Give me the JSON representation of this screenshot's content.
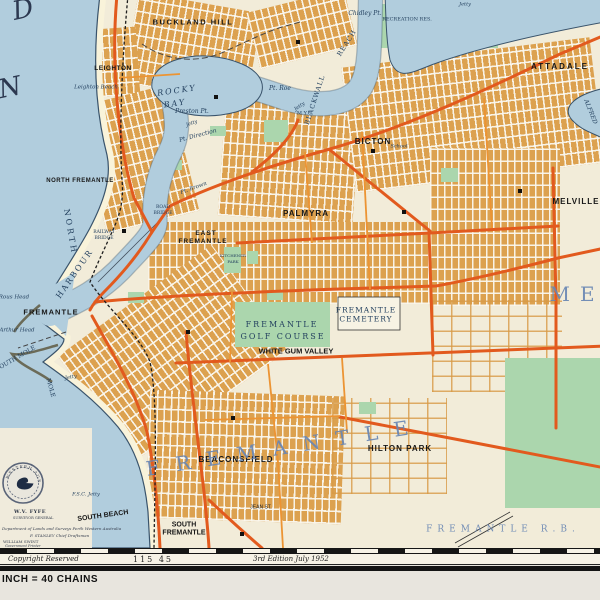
{
  "map": {
    "labels": [
      {
        "t": "D",
        "cls": "lbig",
        "x": 23,
        "y": 10,
        "fs": 26,
        "r": -12
      },
      {
        "t": "N",
        "cls": "lbig",
        "x": 10,
        "y": 88,
        "fs": 26,
        "r": -12
      },
      {
        "t": "BUCKLAND HILL",
        "cls": "lb",
        "x": 193,
        "y": 22,
        "fs": 7.5,
        "ls": 1.5
      },
      {
        "t": "LEIGHTON",
        "cls": "lb",
        "x": 113,
        "y": 69,
        "fs": 6.5,
        "ls": 0.5
      },
      {
        "t": "Leighton Beach",
        "cls": "li",
        "x": 96,
        "y": 88,
        "fs": 5.5
      },
      {
        "t": "ROCKY",
        "cls": "li",
        "x": 177,
        "y": 91,
        "fs": 8,
        "ls": 2,
        "r": -8
      },
      {
        "t": "BAY",
        "cls": "li",
        "x": 175,
        "y": 104,
        "fs": 8,
        "ls": 2,
        "r": -8
      },
      {
        "t": "NORTH FREMANTLE",
        "cls": "lb",
        "x": 80,
        "y": 181,
        "fs": 6,
        "ls": 0.5
      },
      {
        "t": "NORTH",
        "cls": "ls",
        "x": 70,
        "y": 232,
        "fs": 8,
        "ls": 3,
        "r": 80
      },
      {
        "t": "HARBOUR",
        "cls": "ls",
        "x": 75,
        "y": 274,
        "fs": 8,
        "ls": 2,
        "r": -55
      },
      {
        "t": "BLACKWALL",
        "cls": "ls",
        "x": 315,
        "y": 100,
        "fs": 6.5,
        "ls": 1,
        "r": -72
      },
      {
        "t": "REACH",
        "cls": "ls",
        "x": 347,
        "y": 43,
        "fs": 6.5,
        "ls": 1,
        "r": -58
      },
      {
        "t": "Chidley Pt.",
        "cls": "li",
        "x": 365,
        "y": 14,
        "fs": 6
      },
      {
        "t": "Jetty",
        "cls": "li",
        "x": 465,
        "y": 5,
        "fs": 5
      },
      {
        "t": "RECREATION RES.",
        "cls": "ls",
        "x": 407,
        "y": 20,
        "fs": 5
      },
      {
        "t": "ATTADALE",
        "cls": "lb",
        "x": 560,
        "y": 67,
        "fs": 8,
        "ls": 2
      },
      {
        "t": "ALFRED",
        "cls": "li",
        "x": 590,
        "y": 112,
        "fs": 6,
        "r": 68
      },
      {
        "t": "Pt. Roe",
        "cls": "li",
        "x": 280,
        "y": 89,
        "fs": 6
      },
      {
        "t": "Preston Pt.",
        "cls": "li",
        "x": 192,
        "y": 112,
        "fs": 6
      },
      {
        "t": "Jetty",
        "cls": "li",
        "x": 192,
        "y": 124,
        "fs": 5,
        "r": -20
      },
      {
        "t": "Pt. Direction",
        "cls": "li",
        "x": 198,
        "y": 136,
        "fs": 6,
        "r": -15
      },
      {
        "t": "Jetty",
        "cls": "li",
        "x": 300,
        "y": 107,
        "fs": 5,
        "r": -35
      },
      {
        "t": "M.Y.C.",
        "cls": "ls",
        "x": 305,
        "y": 114,
        "fs": 5
      },
      {
        "t": "BICTON",
        "cls": "lb",
        "x": 373,
        "y": 142,
        "fs": 8,
        "ls": 1
      },
      {
        "t": "School",
        "cls": "li",
        "x": 399,
        "y": 147,
        "fs": 5
      },
      {
        "t": "Pt. Brown",
        "cls": "li",
        "x": 194,
        "y": 189,
        "fs": 5.5,
        "r": -20
      },
      {
        "t": "ROAD",
        "cls": "ls",
        "x": 163,
        "y": 208,
        "fs": 4.5
      },
      {
        "t": "BRIDGE",
        "cls": "ls",
        "x": 163,
        "y": 214,
        "fs": 4.5
      },
      {
        "t": "RAILWAY",
        "cls": "ls",
        "x": 104,
        "y": 233,
        "fs": 4.5
      },
      {
        "t": "BRIDGE",
        "cls": "ls",
        "x": 104,
        "y": 239,
        "fs": 4.5
      },
      {
        "t": "PALMYRA",
        "cls": "lb",
        "x": 306,
        "y": 214,
        "fs": 8,
        "ls": 1
      },
      {
        "t": "EAST",
        "cls": "lb",
        "x": 206,
        "y": 234,
        "fs": 6.5,
        "ls": 1
      },
      {
        "t": "FREMANTLE",
        "cls": "lb",
        "x": 203,
        "y": 242,
        "fs": 6.5,
        "ls": 1
      },
      {
        "t": "KITCHENER",
        "cls": "ls",
        "x": 233,
        "y": 256,
        "fs": 4
      },
      {
        "t": "PARK",
        "cls": "ls",
        "x": 233,
        "y": 262,
        "fs": 4
      },
      {
        "t": "MELVILLE",
        "cls": "lb",
        "x": 576,
        "y": 202,
        "fs": 8,
        "ls": 1
      },
      {
        "t": "ME",
        "cls": "lblue",
        "x": 577,
        "y": 294,
        "fs": 20,
        "ls": 10
      },
      {
        "t": "FREMANTLE",
        "cls": "lb",
        "x": 51,
        "y": 312,
        "fs": 7.5,
        "ls": 1
      },
      {
        "t": "Rous Head",
        "cls": "li",
        "x": 14,
        "y": 298,
        "fs": 5.5
      },
      {
        "t": "Arthur Head",
        "cls": "li",
        "x": 17,
        "y": 331,
        "fs": 5.5
      },
      {
        "t": "SOUTH MOLE",
        "cls": "ls",
        "x": 16,
        "y": 359,
        "fs": 6,
        "r": -30
      },
      {
        "t": "MOLE",
        "cls": "ls",
        "x": 50,
        "y": 388,
        "fs": 6,
        "r": 75
      },
      {
        "t": "Jetty",
        "cls": "li",
        "x": 71,
        "y": 378,
        "fs": 5,
        "r": -10
      },
      {
        "t": "FREMANTLE",
        "cls": "ls",
        "x": 282,
        "y": 325,
        "fs": 8,
        "ls": 2
      },
      {
        "t": "GOLF COURSE",
        "cls": "ls",
        "x": 283,
        "y": 337,
        "fs": 8,
        "ls": 2
      },
      {
        "t": "WHITE GUM VALLEY",
        "cls": "lb",
        "x": 296,
        "y": 351,
        "fs": 7.5
      },
      {
        "t": "FREMANTLE",
        "cls": "ls",
        "x": 366,
        "y": 310,
        "fs": 7.5,
        "ls": 1
      },
      {
        "t": "CEMETERY",
        "cls": "ls",
        "x": 366,
        "y": 319,
        "fs": 7.5,
        "ls": 1
      },
      {
        "t": "BEACONSFIELD",
        "cls": "lb",
        "x": 236,
        "y": 460,
        "fs": 8,
        "ls": 1
      },
      {
        "t": "HILTON PARK",
        "cls": "lb",
        "x": 400,
        "y": 449,
        "fs": 8,
        "ls": 1
      },
      {
        "t": "FREMANTLE",
        "cls": "lblue",
        "x": 285,
        "y": 447,
        "fs": 20,
        "ls": 16,
        "r": -9
      },
      {
        "t": "F.S.C. Jetty",
        "cls": "li",
        "x": 86,
        "y": 495,
        "fs": 5
      },
      {
        "t": "SOUTH BEACH",
        "cls": "lb",
        "x": 103,
        "y": 516,
        "fs": 7,
        "r": -8
      },
      {
        "t": "JEAN ST.",
        "cls": "lt",
        "x": 261,
        "y": 508,
        "fs": 5
      },
      {
        "t": "SOUTH",
        "cls": "lb",
        "x": 184,
        "y": 525,
        "fs": 7
      },
      {
        "t": "FREMANTLE",
        "cls": "lb",
        "x": 184,
        "y": 533,
        "fs": 7
      },
      {
        "t": "FREMANTLE  R.B.",
        "cls": "lblue",
        "x": 503,
        "y": 530,
        "fs": 9,
        "ls": 5
      }
    ]
  },
  "margin": {
    "copyright": "Copyright Reserved",
    "sheet_number": "115 45",
    "edition": "3rd Edition  July 1952",
    "scale_text": "INCH = 40 CHAINS"
  },
  "credits": {
    "seal_text": "WESTERN AUSTRALIA",
    "surveyor": "W.V. FYFE",
    "surveyor_title": "SURVEYOR GENERAL",
    "dept": "Department of Lands and Surveys Perth Western Australia",
    "draftsman": "F. STANLEY  Chief Draftsman",
    "printer_name": "WILLIAM SWINT",
    "printer_title": "Government Printer"
  },
  "colors": {
    "water": "#b1cddd",
    "land": "#f2ecd9",
    "urban": "#dca14f",
    "major_road": "#e25a1e",
    "minor_road": "#ec9433",
    "park": "#abd6ad",
    "district_text": "#6886b3",
    "neatline": "#141414"
  }
}
